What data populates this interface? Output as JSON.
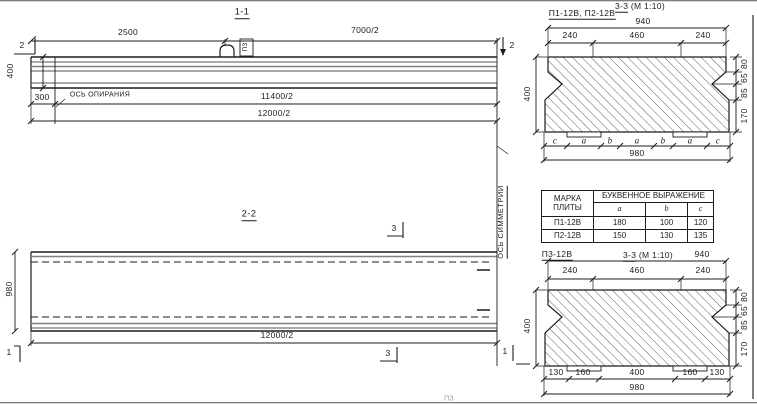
{
  "section_1_1": {
    "title": "1-1",
    "cut_mark_left": "2",
    "cut_mark_right": "2",
    "dim_top_left": "2500",
    "dim_top_right": "7000/2",
    "dim_height": "400",
    "dim_bearing_offset": "300",
    "bearing_axis_label": "ОСЬ ОПИРАНИЯ",
    "loop_label": "П3",
    "dim_bottom_upper": "11400/2",
    "dim_bottom_lower": "12000/2"
  },
  "section_2_2": {
    "title": "2-2",
    "dim_width": "980",
    "dim_length": "12000/2",
    "cut_mark_top": "3",
    "cut_mark_bottom": "3",
    "cut_mark_left": "1",
    "cut_mark_right": "1",
    "symmetry_axis_label": "ОСЬ СИММЕТРИИ"
  },
  "section_3_3_top": {
    "label": "П1-12В, П2-12В",
    "title": "3-3",
    "title_scale": "(М 1:10)",
    "dim_total_top": "940",
    "dims_top": [
      "240",
      "460",
      "240"
    ],
    "dim_left": "400",
    "dims_right": [
      "80",
      "65",
      "85",
      "170"
    ],
    "letter_dims": [
      "c",
      "a",
      "b",
      "a",
      "b",
      "a",
      "c"
    ],
    "dim_total_bottom": "980"
  },
  "plate_table": {
    "header_col1_line1": "МАРКА",
    "header_col1_line2": "ПЛИТЫ",
    "header_group": "БУКВЕННОЕ ВЫРАЖЕНИЕ",
    "letter_cols": [
      "a",
      "b",
      "c"
    ],
    "rows": [
      {
        "mark": "П1-12В",
        "a": "180",
        "b": "100",
        "c": "120"
      },
      {
        "mark": "П2-12В",
        "a": "150",
        "b": "130",
        "c": "135"
      }
    ]
  },
  "section_3_3_bottom": {
    "label": "П3-12В",
    "title": "3-3",
    "title_scale": "(М 1:10)",
    "dim_total_top": "940",
    "dims_top": [
      "240",
      "460",
      "240"
    ],
    "dim_left": "400",
    "dims_right": [
      "80",
      "65",
      "85",
      "170"
    ],
    "dims_bottom": [
      "130",
      "160",
      "400",
      "160",
      "130"
    ],
    "dim_total_bottom": "980"
  },
  "stray_text": "ПЗ",
  "colors": {
    "line": "#1c1c1c",
    "paper": "#ffffff"
  }
}
